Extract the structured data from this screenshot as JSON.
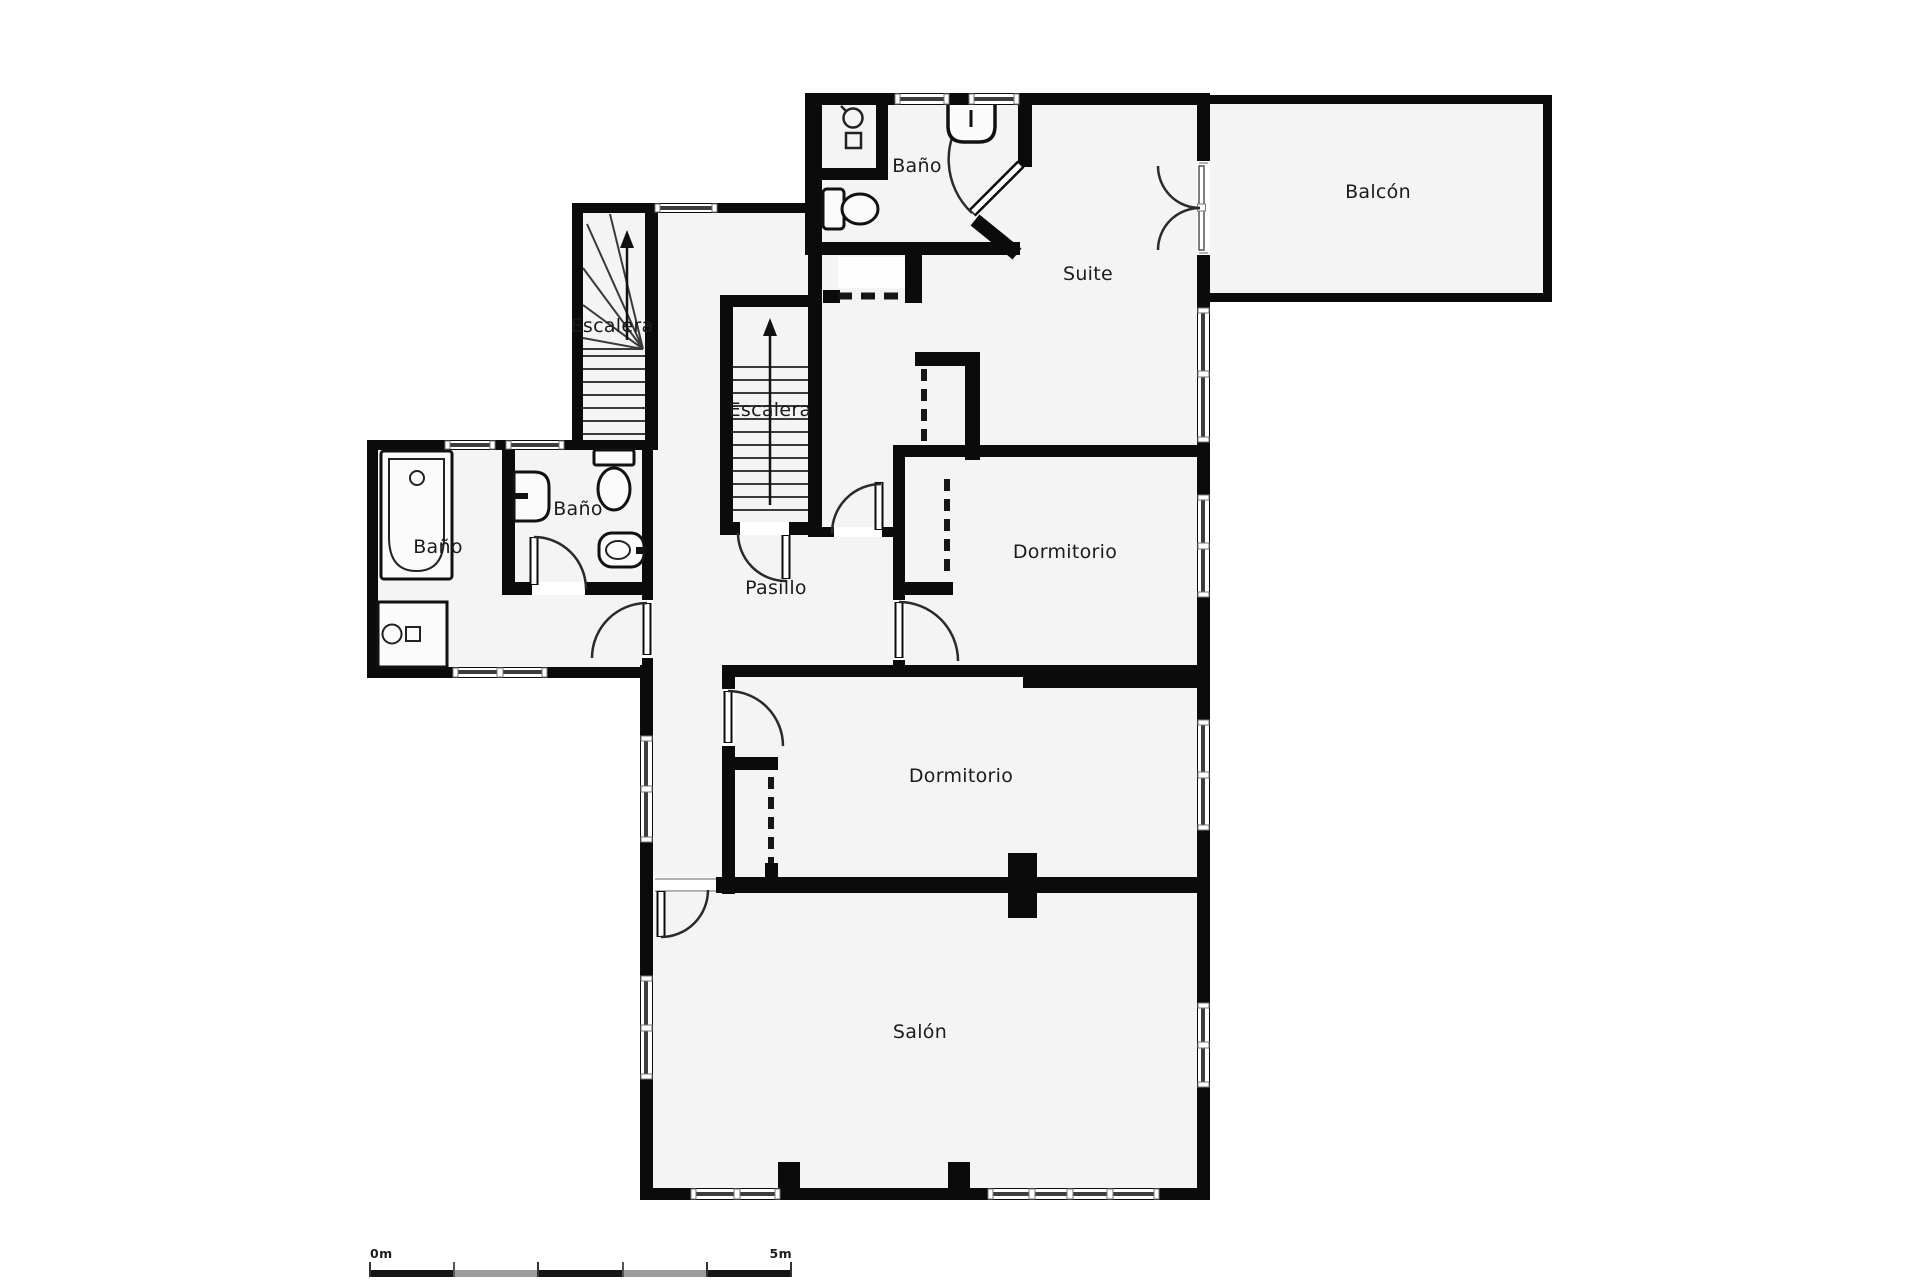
{
  "plan": {
    "labels": {
      "bano_top": "Baño",
      "suite": "Suite",
      "balcon": "Balcón",
      "escalera_upper": "Escalera",
      "escalera_center": "Escalera",
      "bano_middle": "Baño",
      "bano_left": "Baño",
      "pasillo": "Pasillo",
      "dormitorio_right": "Dormitorio",
      "dormitorio_center": "Dormitorio",
      "salon": "Salón"
    },
    "scale_bar": {
      "start_label": "0m",
      "end_label": "5m"
    },
    "colors": {
      "wall": "#0b0b0b",
      "room-fill": "#f4f4f4",
      "fixture-fill": "#fbfbfb",
      "glazing": "#3d3d3d",
      "label": "#1b1b1b",
      "arc": "#2a2a2a",
      "scale-dark": "#151515",
      "scale-light": "#9b9b9b"
    },
    "icons": [
      "bathtub-icon",
      "washing-machine-icon",
      "sink-icon",
      "toilet-icon",
      "bidet-icon",
      "shower-icon",
      "stairs-arrow-icon",
      "door-swing-icon",
      "sliding-door-icon",
      "window-icon"
    ]
  }
}
